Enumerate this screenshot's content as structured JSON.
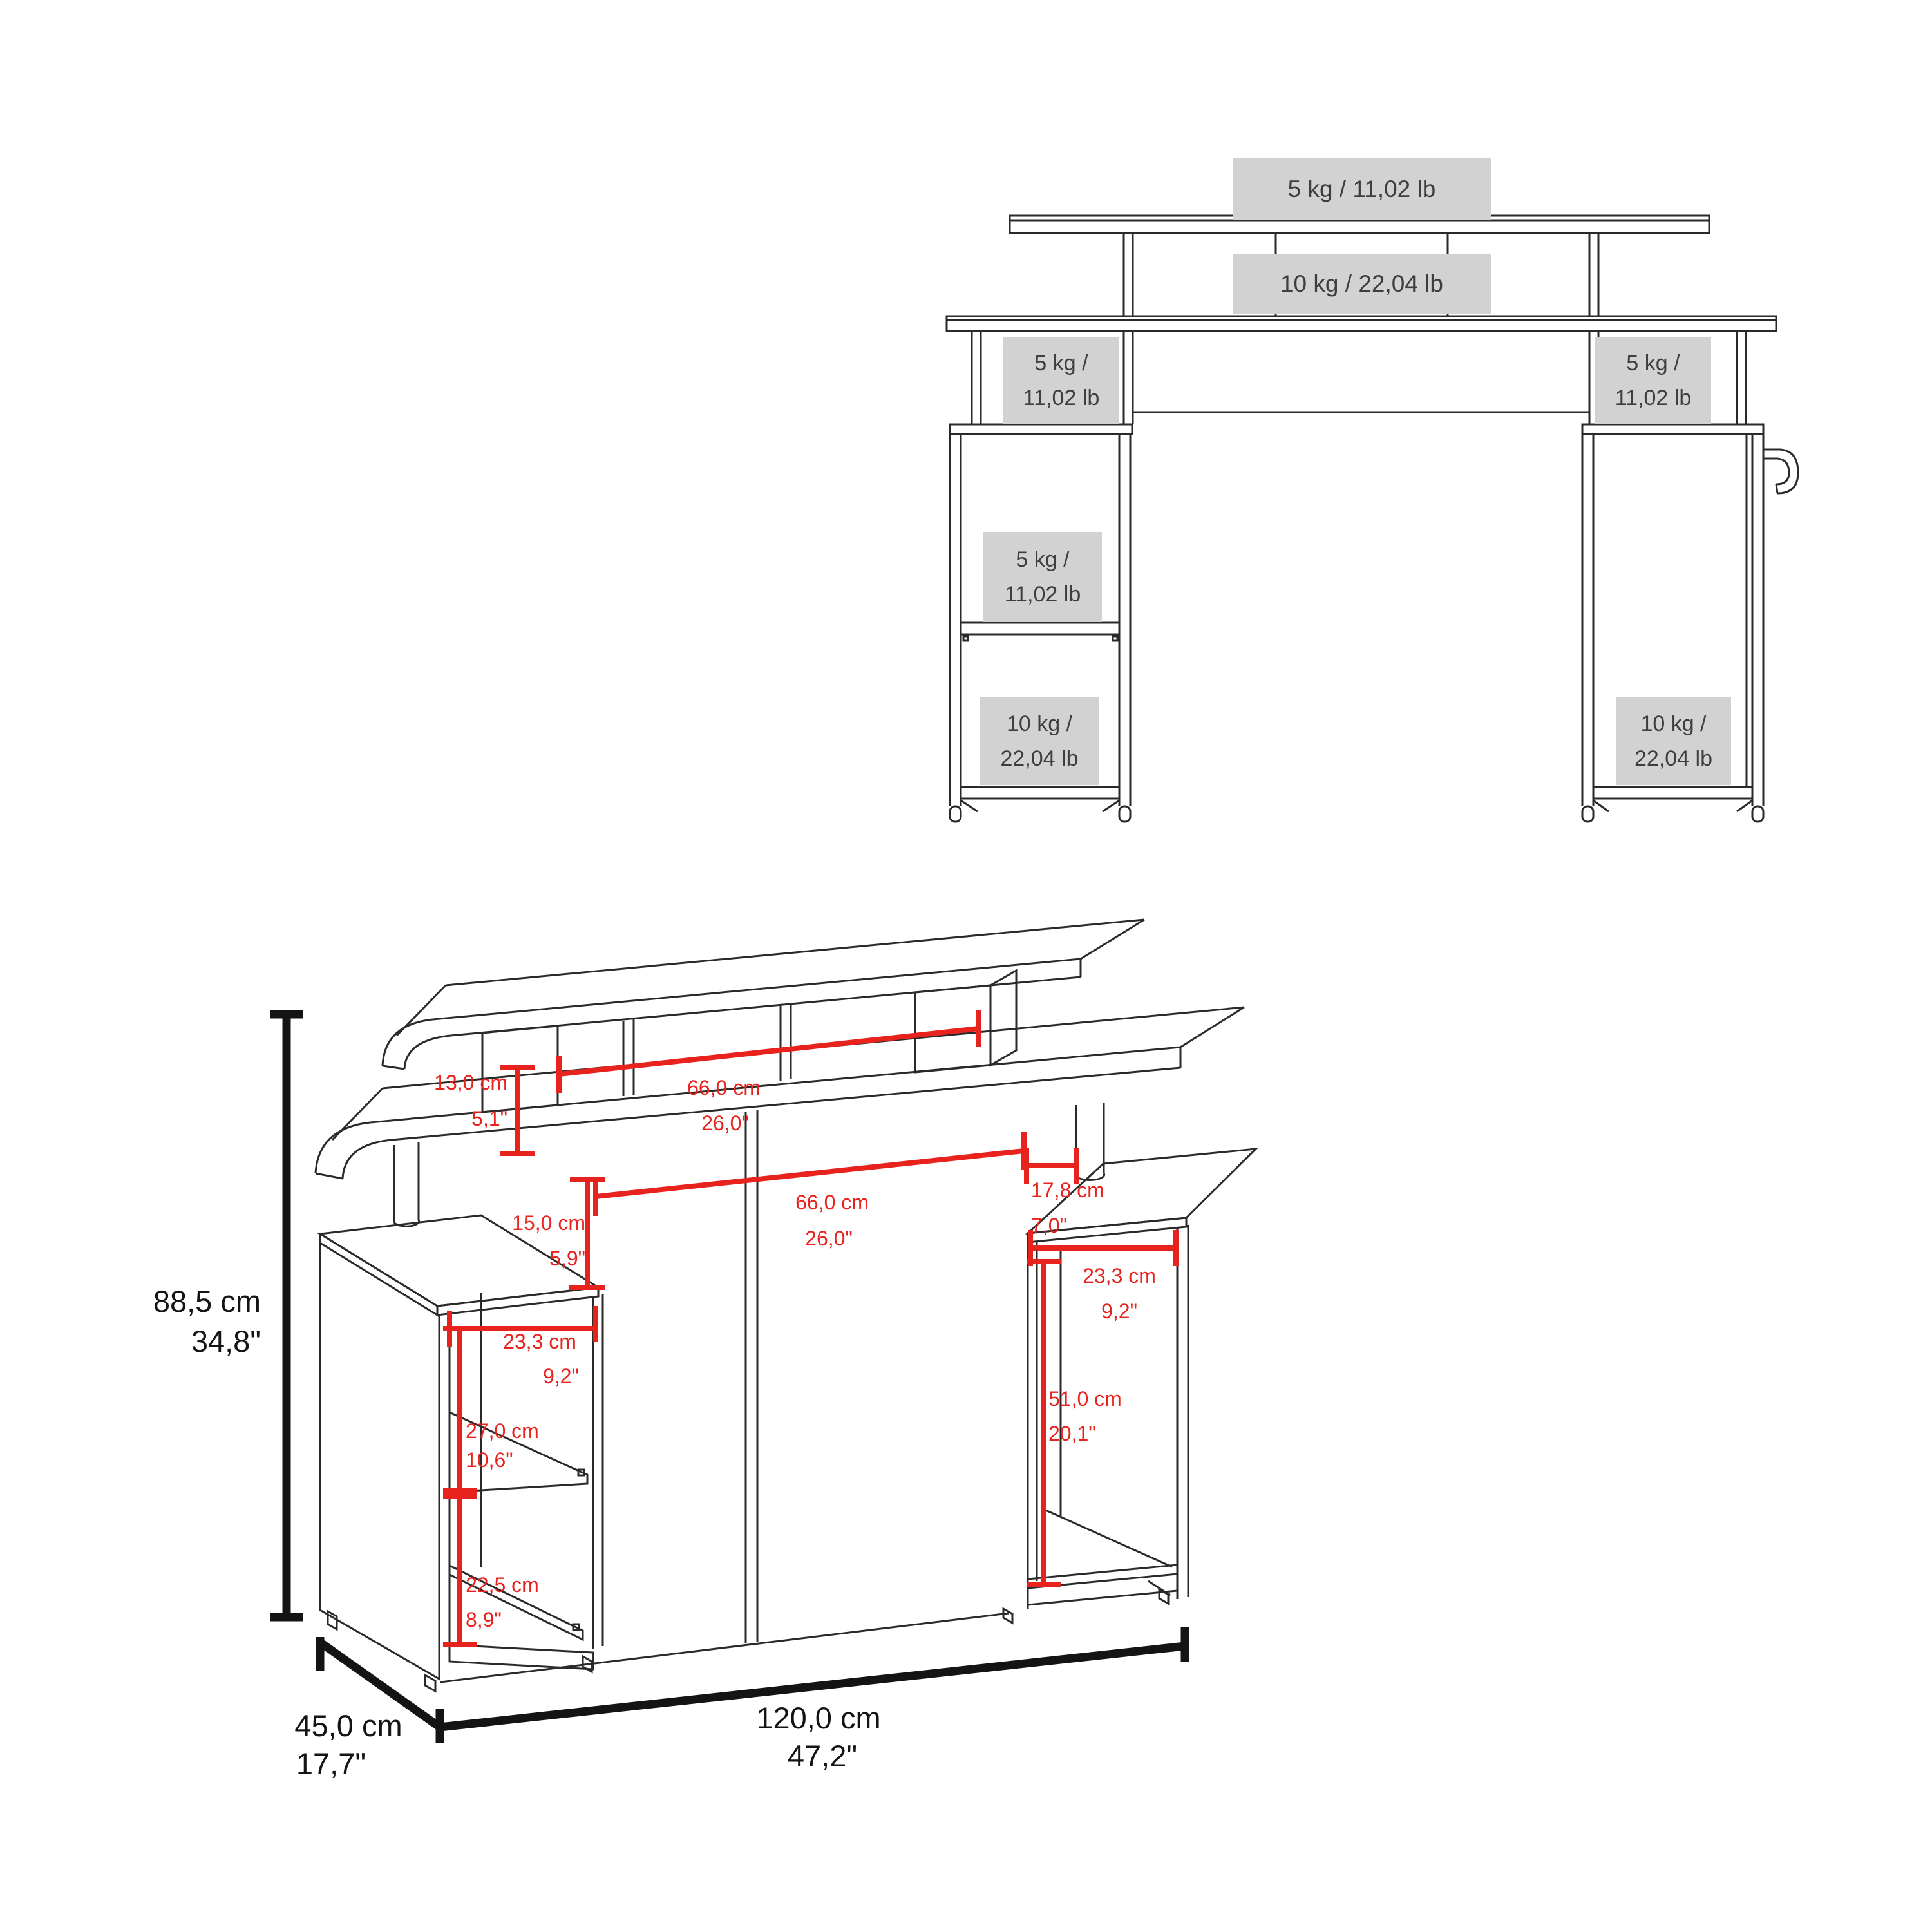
{
  "colors": {
    "background": "#ffffff",
    "linework": "#2b2a29",
    "dimension_red": "#e8231d",
    "dimension_black": "#141414",
    "label_box_bg": "#d2d2d2",
    "label_text": "#3f3e3e"
  },
  "front_view": {
    "load_labels": [
      {
        "id": "monitor_shelf",
        "text": "5 kg / 11,02 lb"
      },
      {
        "id": "desktop",
        "text": "10 kg / 22,04 lb"
      },
      {
        "id": "left_riser",
        "line1": "5 kg /",
        "line2": "11,02 lb"
      },
      {
        "id": "right_riser",
        "line1": "5 kg /",
        "line2": "11,02 lb"
      },
      {
        "id": "left_middle_shelf",
        "line1": "5 kg /",
        "line2": "11,02 lb"
      },
      {
        "id": "left_bottom_shelf",
        "line1": "10 kg /",
        "line2": "22,04 lb"
      },
      {
        "id": "right_cabinet",
        "line1": "10 kg /",
        "line2": "22,04 lb"
      }
    ]
  },
  "dimension_view": {
    "overall_dimensions": {
      "height": {
        "cm": "88,5 cm",
        "in": "34,8\""
      },
      "depth": {
        "cm": "45,0 cm",
        "in": "17,7\""
      },
      "width": {
        "cm": "120,0 cm",
        "in": "47,2\""
      }
    },
    "detail_dimensions": {
      "monitor_shelf_riser_height": {
        "cm": "13,0 cm",
        "in": "5,1\""
      },
      "monitor_shelf_opening_width": {
        "cm": "66,0 cm",
        "in": "26,0\""
      },
      "desktop_opening_width": {
        "cm": "66,0 cm",
        "in": "26,0\""
      },
      "desktop_to_pedestal_height": {
        "cm": "15,0 cm",
        "in": "5,9\""
      },
      "right_pedestal_top_depth": {
        "cm": "17,8 cm",
        "in": "7,0\""
      },
      "right_compartment_width": {
        "cm": "23,3 cm",
        "in": "9,2\""
      },
      "right_compartment_height": {
        "cm": "51,0 cm",
        "in": "20,1\""
      },
      "left_compartment_width": {
        "cm": "23,3 cm",
        "in": "9,2\""
      },
      "left_upper_compartment_height": {
        "cm": "27,0 cm",
        "in": "10,6\""
      },
      "left_lower_compartment_height": {
        "cm": "22,5 cm",
        "in": "8,9\""
      }
    }
  }
}
